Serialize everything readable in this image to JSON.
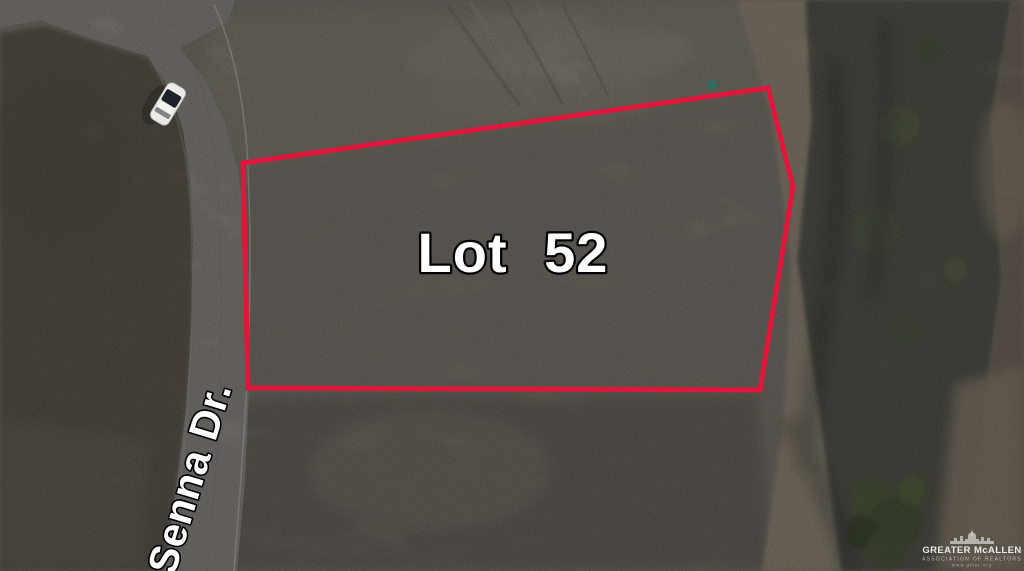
{
  "annotations": {
    "lot_label": "Lot 52",
    "street_label": "Senna Dr."
  },
  "watermark": {
    "org": "GREATER McALLEN",
    "tagline": "ASSOCIATION OF REALTORS",
    "website": "www.gmar.org"
  },
  "colors": {
    "boundary_red": "#E0173A",
    "road_gray": "#8E8A84",
    "dirt_base": "#7B7369",
    "scrub_dark": "#574C41",
    "vegetation_dark": "#4A463C",
    "path_tan": "#998B77",
    "label_fill": "#FFFFFF",
    "label_outline": "#000000"
  }
}
